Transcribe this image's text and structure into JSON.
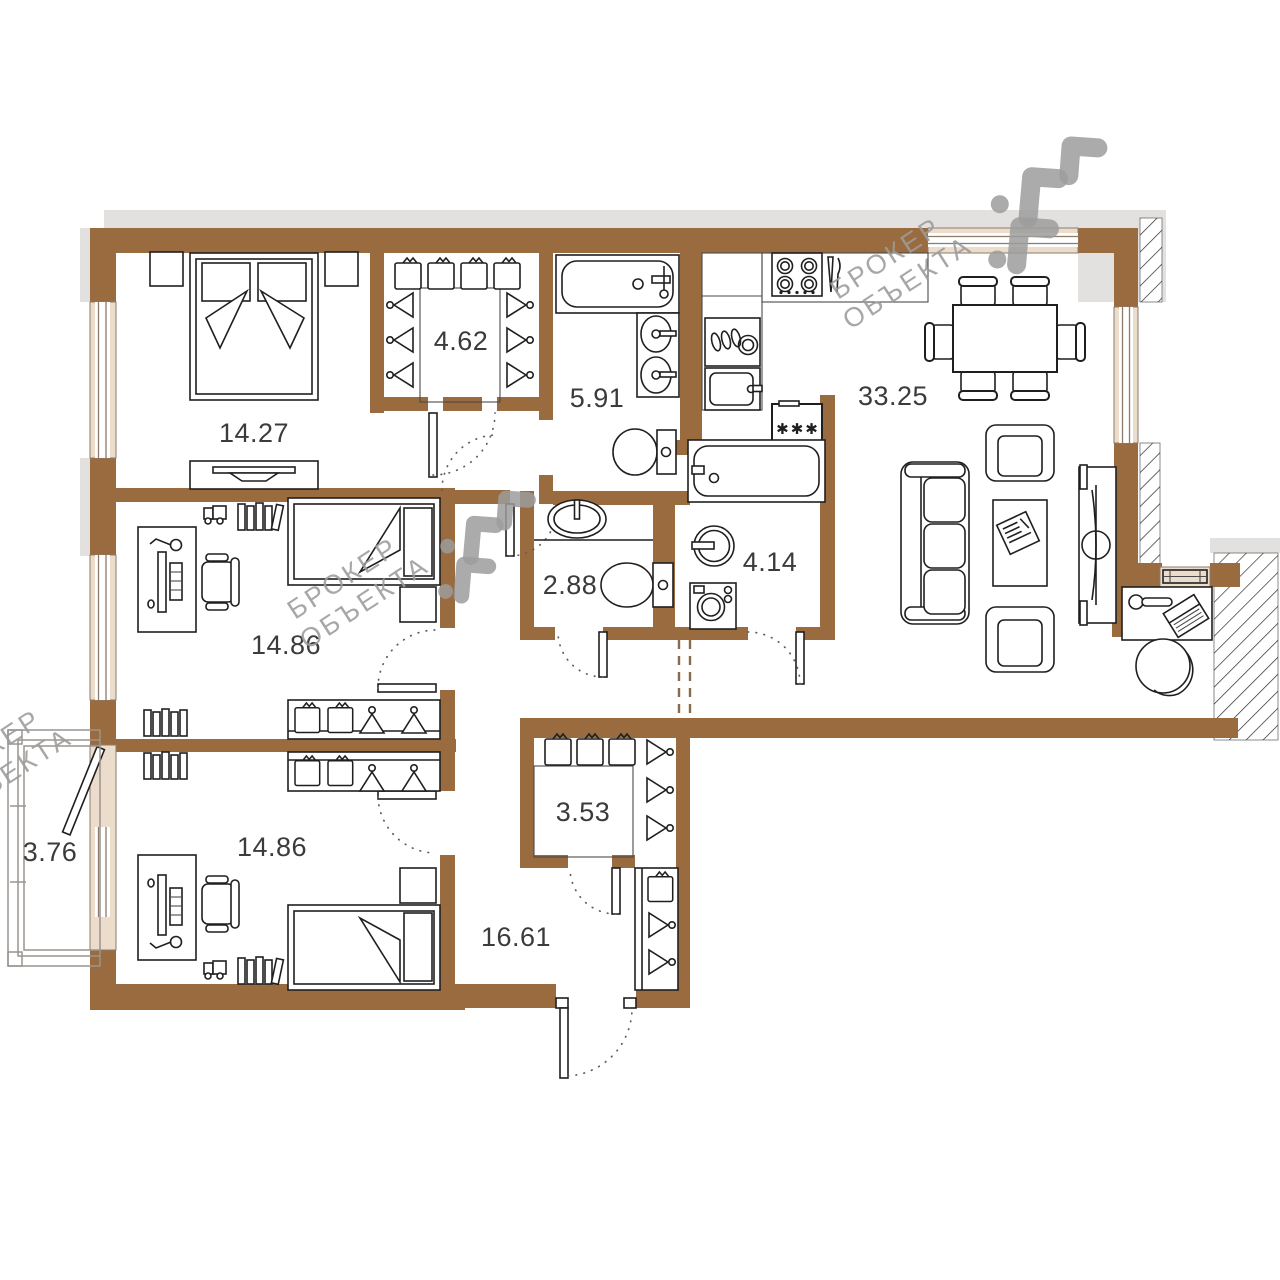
{
  "title": "Apartment floor plan",
  "watermark": {
    "line1": "БРОКЕР",
    "line2": "ОБЪЕКТА"
  },
  "rooms": {
    "bedroom": {
      "area": "14.27"
    },
    "wardrobe": {
      "area": "4.62"
    },
    "bathroom_1": {
      "area": "5.91"
    },
    "kitchen_living": {
      "area": "33.25"
    },
    "children_1": {
      "area": "14.86"
    },
    "wc": {
      "area": "2.88"
    },
    "bathroom_2": {
      "area": "4.14"
    },
    "children_2": {
      "area": "14.86"
    },
    "closet": {
      "area": "3.53"
    },
    "hallway": {
      "area": "16.61"
    },
    "balcony": {
      "area": "3.76"
    }
  },
  "symbols": {
    "freezer": "✱✱✱"
  },
  "colors": {
    "wall": "#9a6b3f",
    "window": "#ecdccc",
    "exterior_trim": "#e2e1e0",
    "line": "#1f1f1f",
    "watermark": "#9c9c9c",
    "label": "#3b3b3b"
  }
}
